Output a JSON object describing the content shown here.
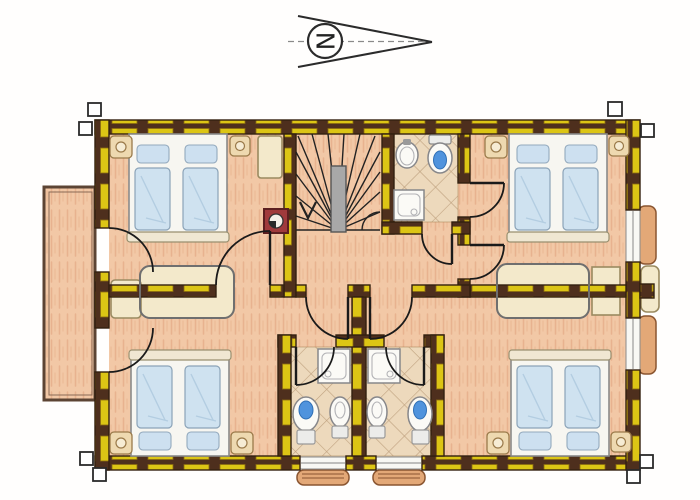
{
  "document": {
    "kind": "scanned hand-drawn architectural floor plan",
    "storey": "upper floor (staircase with down arrow at top centre)",
    "drawing_style": "coloured pencil, timber-frame walls hatched yellow and dark brown"
  },
  "compass": {
    "letter": "N",
    "direction": "pointing right (east of page)"
  },
  "palette": {
    "wall_timber_yellow": "#dcc515",
    "wall_wood_dark": "#4e2f1d",
    "floor_salmon": "#f2c8a6",
    "bathroom_tile_beige": "#edd9bc",
    "furniture_beige": "#f3e9cb",
    "bed_blue": "#cfe2f0",
    "toilet_water_blue": "#4f93dd",
    "chimney_red": "#a03a3c",
    "window_box_tan": "#e3a877",
    "line_dark": "#1a1a1a"
  },
  "rooms": [
    {
      "id": "bedroom-top-left",
      "label": "bedroom top-left",
      "contents": [
        "double bed with 2 pillows",
        "nightstand x2 with lamps",
        "wardrobe",
        "chimney flue",
        "door to balcony",
        "door to hall"
      ]
    },
    {
      "id": "bedroom-top-right",
      "label": "bedroom top-right",
      "contents": [
        "double bed with 2 pillows",
        "nightstand x2 with lamps",
        "wardrobe bench",
        "window with flower box",
        "ensuite door",
        "hall door"
      ]
    },
    {
      "id": "bedroom-bottom-left",
      "label": "bedroom bottom-left",
      "contents": [
        "double bed with 2 pillows",
        "nightstand x2 with lamps",
        "shared wardrobe",
        "door to balcony"
      ]
    },
    {
      "id": "bedroom-bottom-right",
      "label": "bedroom bottom-right",
      "contents": [
        "double bed with 2 pillows",
        "nightstand x2 with lamps",
        "shared wardrobe",
        "window with flower box"
      ]
    },
    {
      "id": "bathroom-top",
      "label": "bathroom top-centre",
      "fixtures": [
        "washbasin",
        "toilet",
        "shower tray"
      ]
    },
    {
      "id": "bathroom-bottom-left",
      "label": "bathroom bottom-left",
      "fixtures": [
        "shower tray",
        "toilet",
        "bidet",
        "window with flower box"
      ]
    },
    {
      "id": "bathroom-bottom-right",
      "label": "bathroom bottom-right",
      "fixtures": [
        "shower tray",
        "toilet",
        "bidet",
        "window with flower box"
      ]
    },
    {
      "id": "staircase",
      "label": "winder staircase",
      "details": [
        "fan treads",
        "grey newel wall",
        "down arrow"
      ]
    },
    {
      "id": "hallway",
      "label": "central hallway with vestibules"
    },
    {
      "id": "balcony",
      "label": "balcony on left side",
      "details": [
        "double outline",
        "two doors from bedrooms"
      ]
    }
  ]
}
